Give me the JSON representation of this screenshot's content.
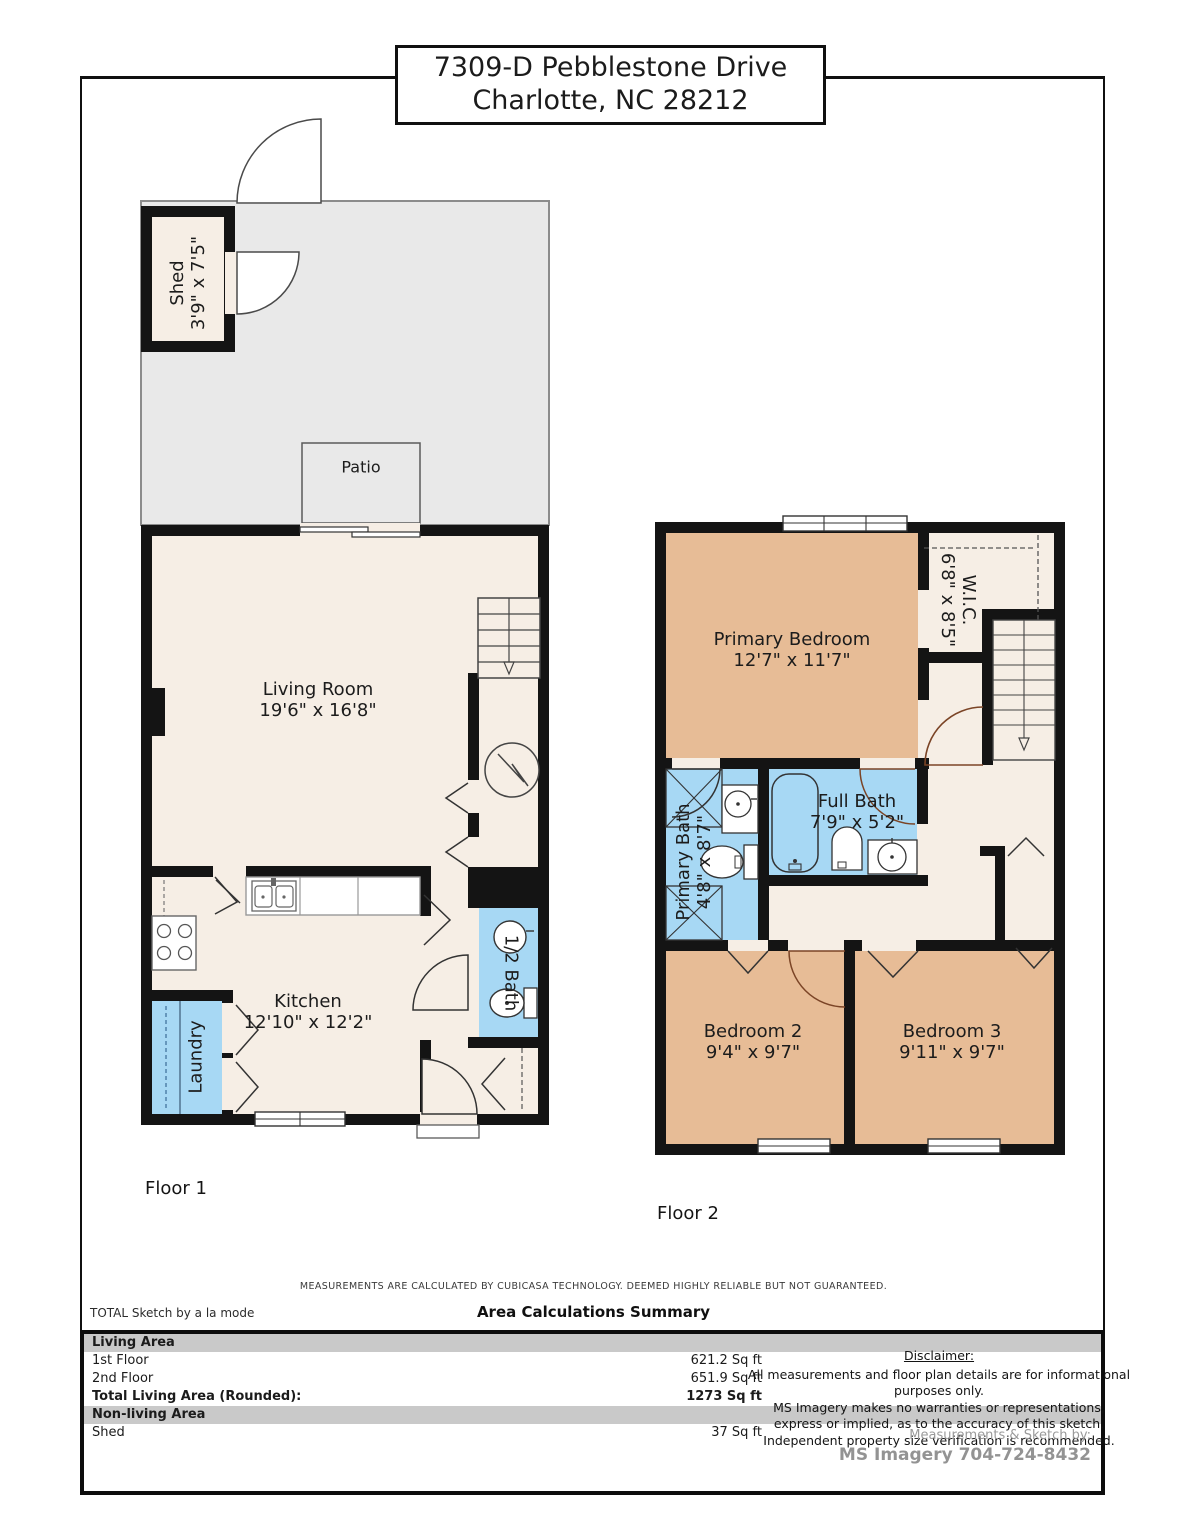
{
  "title": {
    "line1": "7309-D Pebblestone Drive",
    "line2": "Charlotte, NC 28212"
  },
  "floor1": {
    "label": "Floor 1",
    "shed": {
      "name": "Shed",
      "dims": "3'9\" x 7'5\""
    },
    "patio": {
      "name": "Patio"
    },
    "living": {
      "name": "Living Room",
      "dims": "19'6\" x 16'8\""
    },
    "kitchen": {
      "name": "Kitchen",
      "dims": "12'10\" x 12'2\""
    },
    "laundry": {
      "name": "Laundry"
    },
    "half_bath": {
      "name": "1/2 Bath"
    }
  },
  "floor2": {
    "label": "Floor 2",
    "primary_bedroom": {
      "name": "Primary Bedroom",
      "dims": "12'7\" x 11'7\""
    },
    "wic": {
      "name": "W.I.C.",
      "dims": "6'8\" x 8'5\""
    },
    "primary_bath": {
      "name": "Primary Bath",
      "dims": "4'8\" x 8'7\""
    },
    "full_bath": {
      "name": "Full Bath",
      "dims": "7'9\" x 5'2\""
    },
    "bedroom2": {
      "name": "Bedroom 2",
      "dims": "9'4\" x 9'7\""
    },
    "bedroom3": {
      "name": "Bedroom 3",
      "dims": "9'11\" x 9'7\""
    }
  },
  "footer": {
    "measurement_note": "MEASUREMENTS ARE CALCULATED BY CUBICASA TECHNOLOGY. DEEMED HIGHLY RELIABLE BUT NOT GUARANTEED.",
    "brand": "TOTAL Sketch by a la mode",
    "summary_title": "Area Calculations Summary"
  },
  "summary": {
    "rows": [
      {
        "label": "Living Area",
        "value": ""
      },
      {
        "label": "1st Floor",
        "value": "621.2 Sq ft"
      },
      {
        "label": "2nd Floor",
        "value": "651.9 Sq ft"
      },
      {
        "label": "Total Living Area (Rounded):",
        "value": "1273 Sq ft"
      },
      {
        "label": "Non-living Area",
        "value": ""
      },
      {
        "label": "Shed",
        "value": "37 Sq ft"
      }
    ]
  },
  "disclaimer": {
    "title": "Disclaimer:",
    "line1": "All measurements and floor plan details are for informational purposes only.",
    "line2": "MS Imagery makes no warranties or representations,",
    "line3": "express or implied, as to the accuracy of this sketch.",
    "line4": "Independent property size verification is recommended.",
    "credit_label": "Measurements & Sketch by:",
    "credit_value": "MS Imagery  704-724-8432"
  },
  "colors": {
    "wall": "#141414",
    "floor": "#f6eee5",
    "bedroom": "#e7bc96",
    "bath": "#a7d8f4",
    "yard": "#e9e9e9",
    "door_arc": "#7b4426"
  }
}
